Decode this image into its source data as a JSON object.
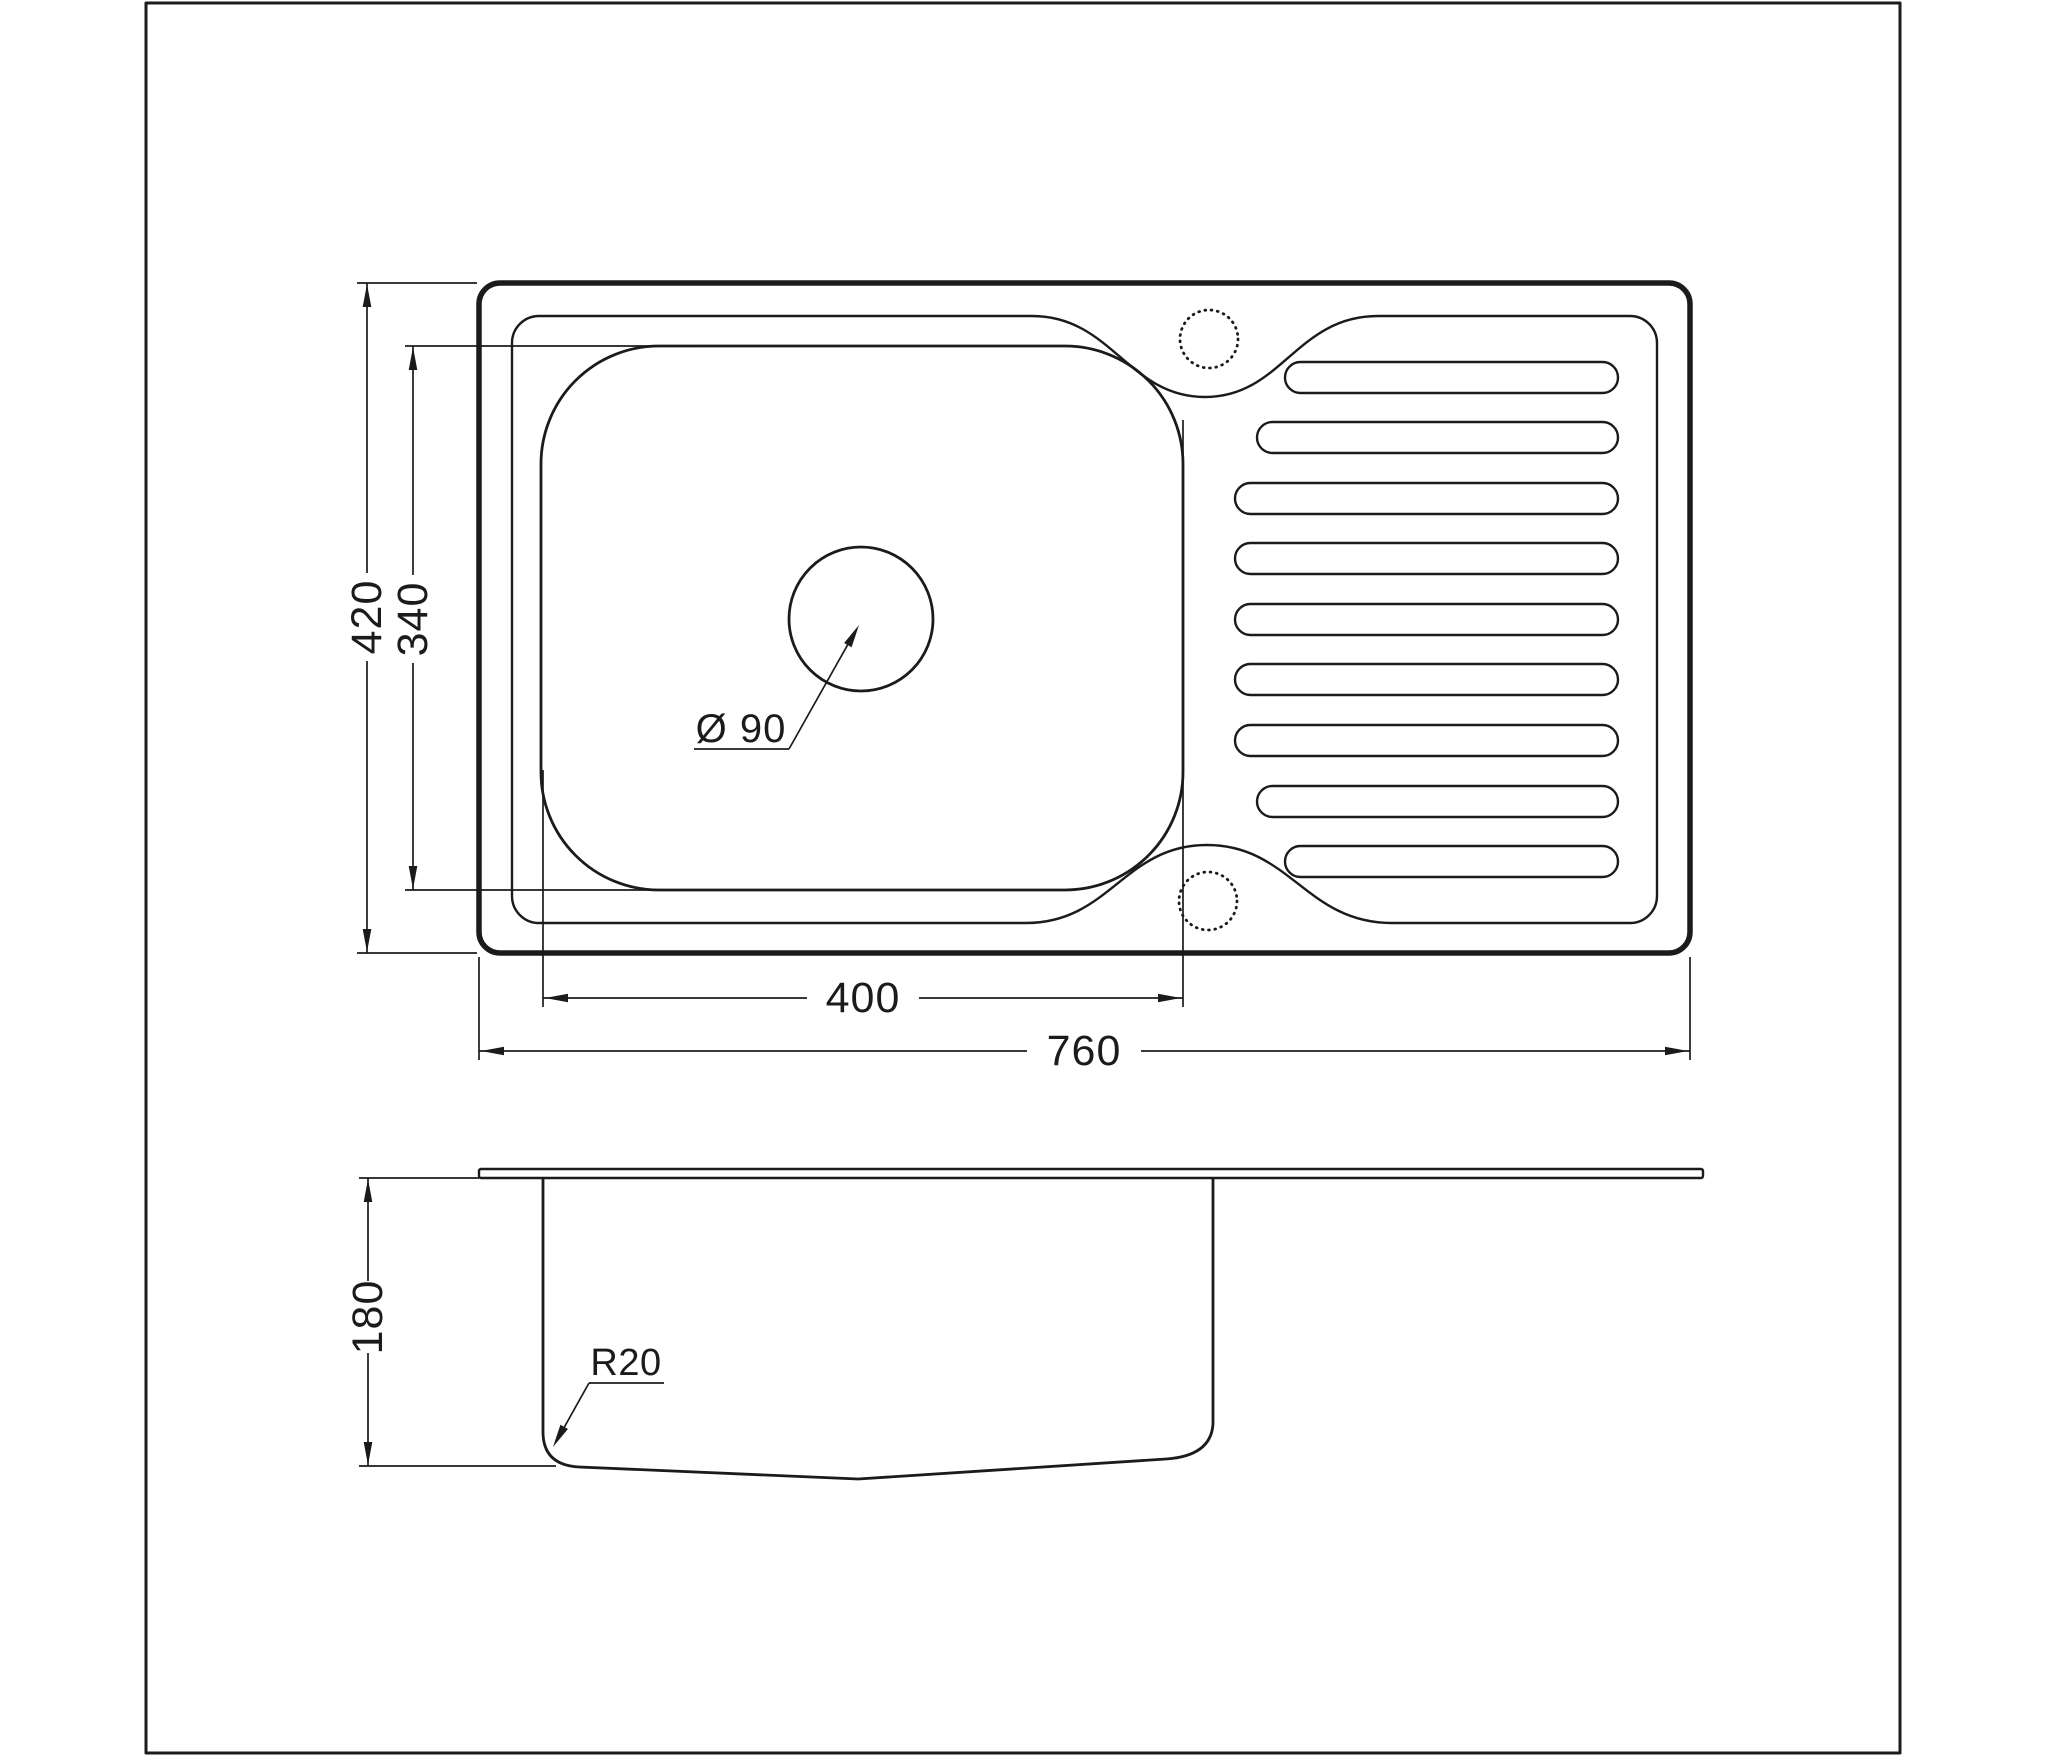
{
  "page": {
    "background": "#ffffff",
    "line_color": "#1b1b1d"
  },
  "top_view": {
    "label_total_width": "760",
    "label_total_depth": "420",
    "label_bowl_width": "400",
    "label_bowl_depth": "340",
    "label_drain_diameter": "Ø 90",
    "drainboard_slot_count": 9,
    "tap_hole_count": 2
  },
  "side_view": {
    "label_depth": "180",
    "label_corner_radius": "R20"
  }
}
